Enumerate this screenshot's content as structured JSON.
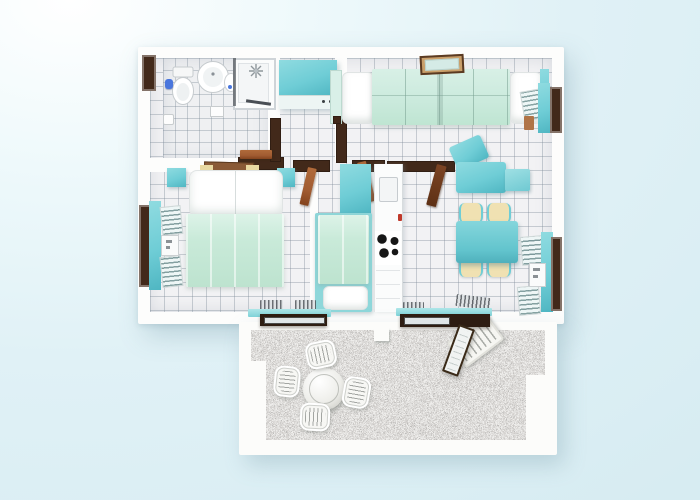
{
  "scene": {
    "kind": "3D rendered apartment floor plan, top-down view, no visible text",
    "rooms": [
      {
        "name": "bathroom",
        "contents": [
          "toilet",
          "washbasin",
          "small basin",
          "shower enclosure",
          "floor drain",
          "toilet paper holder",
          "window"
        ]
      },
      {
        "name": "hallway",
        "contents": [
          "teal wardrobe cabinet"
        ]
      },
      {
        "name": "living-room",
        "contents": [
          "mint four-seat sofa with white end cushions",
          "wall picture frame",
          "shuttered window"
        ]
      },
      {
        "name": "bedroom",
        "contents": [
          "double bed with mint blanket and white pillows",
          "wood headboard",
          "two teal nightstands",
          "shuttered window",
          "doormats"
        ]
      },
      {
        "name": "second-bedroom",
        "contents": [
          "single bed with mint blanket",
          "teal cabinet"
        ]
      },
      {
        "name": "kitchen",
        "contents": [
          "white counter strip",
          "sink",
          "cooktop with 4 burners",
          "doormat"
        ]
      },
      {
        "name": "dining-area",
        "contents": [
          "teal dining table",
          "4 cream chairs",
          "teal chaise armchair with ottoman",
          "shuttered window",
          "doormat"
        ]
      },
      {
        "name": "terrace",
        "contents": [
          "gravel floor",
          "round white patio table",
          "4 white patio chairs",
          "sun lounger",
          "open glass door"
        ]
      }
    ],
    "open_door_leaves": 5
  },
  "counts": {
    "stove_burners": 4,
    "dining_chairs": 4,
    "patio_chairs": 4,
    "windows_with_shutters": 3,
    "terrace_doorways": 2
  },
  "palette": {
    "background": "#e0f1f6",
    "wall": "#fdfdfc",
    "tile": "#f2f2f4",
    "teal": "#6fcdd6",
    "teal_light": "#8fdbe0",
    "teal_deep": "#4fb6c2",
    "mint": "#cbeadd",
    "mint_pale": "#d9f0e8",
    "wood_dark": "#42291a",
    "wood_red": "#a15c32",
    "wood_light": "#b07447",
    "cream": "#f0e1b2",
    "frame_tan": "#c99f6a",
    "accent_blue": "#4a76dd",
    "gravel_gray": "#a9a5a0"
  }
}
